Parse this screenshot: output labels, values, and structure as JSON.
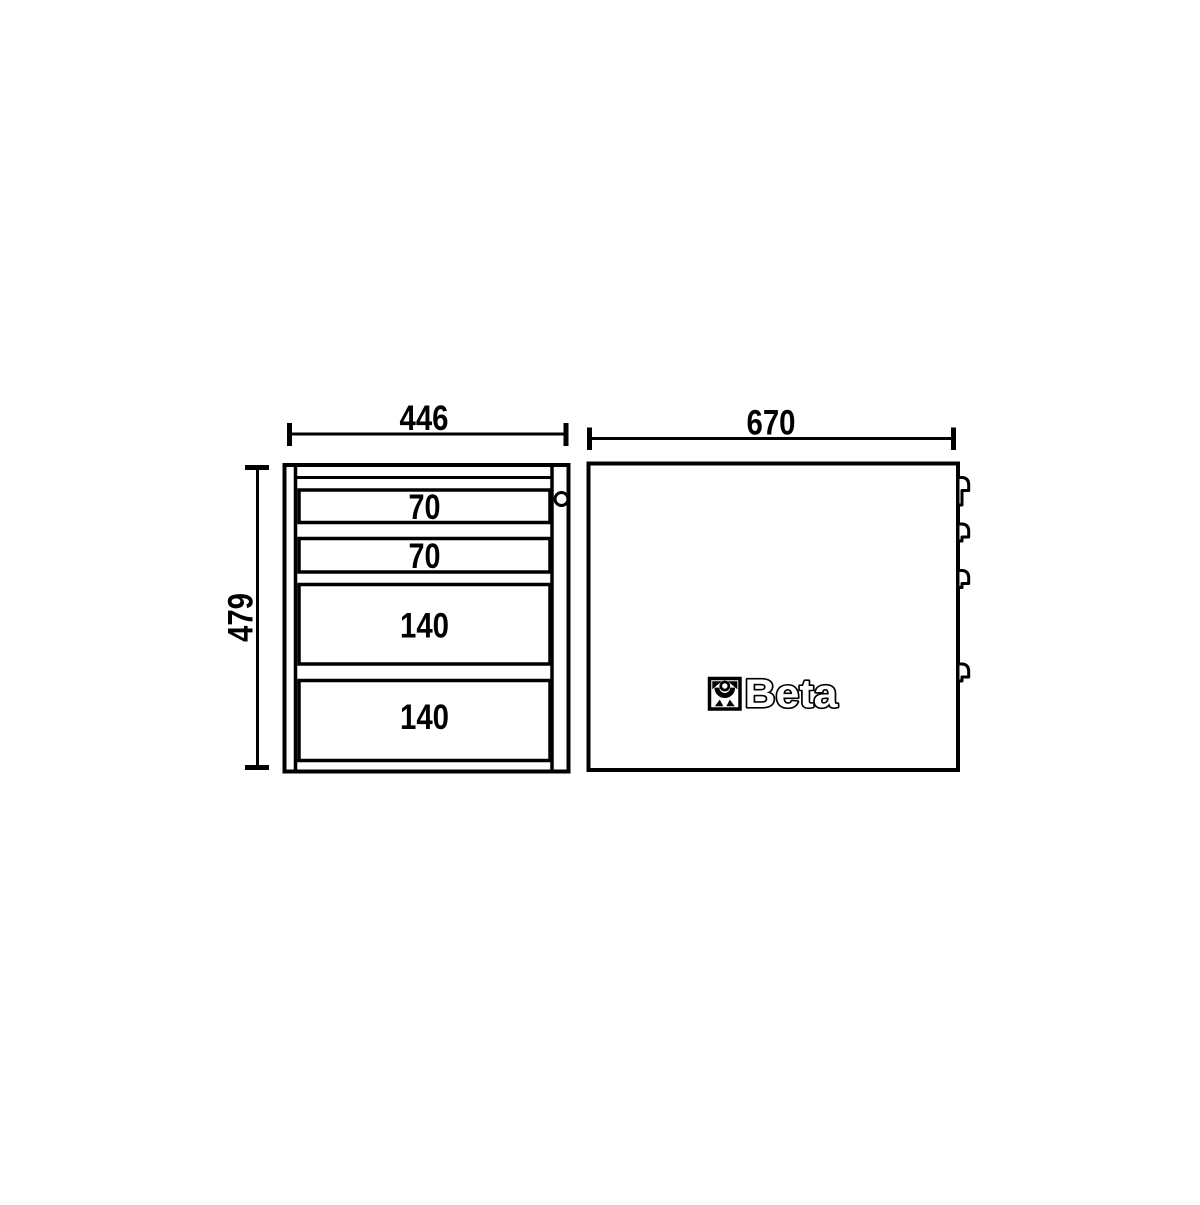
{
  "colors": {
    "line_color": "#000000",
    "background_color": "#ffffff"
  },
  "front_view": {
    "width_dimension": "446",
    "height_dimension": "479",
    "drawers": [
      {
        "label": "70"
      },
      {
        "label": "70"
      },
      {
        "label": "140"
      },
      {
        "label": "140"
      }
    ]
  },
  "side_view": {
    "depth_dimension": "670",
    "brand_text": "Beta"
  }
}
